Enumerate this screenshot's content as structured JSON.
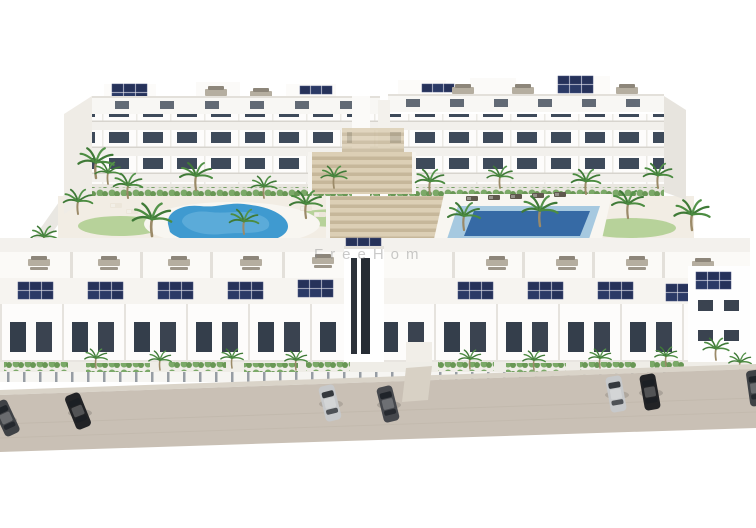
{
  "scene": {
    "type": "aerial-3d-architectural-render",
    "subject": "white residential apartment complex with courtyard, two swimming pools, palm trees, rooftop solar panels and street parking",
    "watermark_text": "FreeHom"
  },
  "colors": {
    "background": "#ffffff",
    "street": "#c9c0b5",
    "curb": "#dad4c9",
    "building_white": "#fdfcfb",
    "building_shade": "#efece6",
    "roof_band": "#f8f7f4",
    "window_dark": "#3e4a5a",
    "solar_panel": "#26325a",
    "pool_left": "#3f9ad0",
    "pool_right": "#a6c9e0",
    "pool_right_deep": "#2a5f9e",
    "palm_green": "#4c8c41",
    "grass_green": "#b7d29a",
    "steps_beige": "#dccfb5",
    "courtyard_ground": "#f2ede4",
    "car_black": "#222326",
    "car_silver": "#c7c9cb",
    "car_gray": "#46484d",
    "car_dark": "#3f4246",
    "watermark_gray": "#8c8c8c"
  }
}
